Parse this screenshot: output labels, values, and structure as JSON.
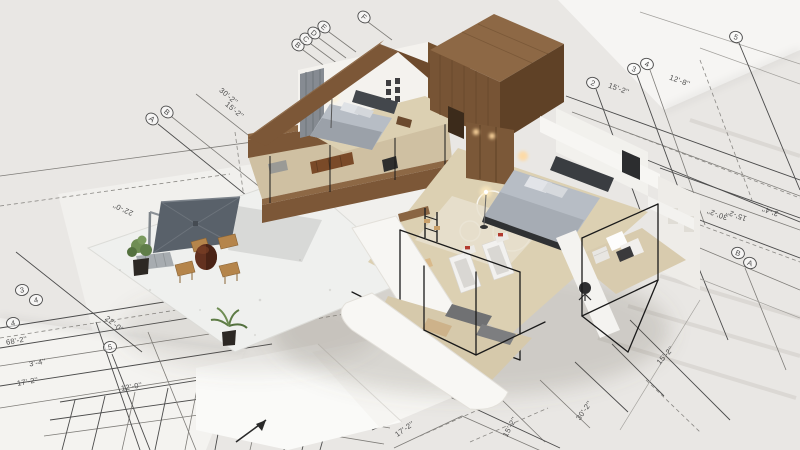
{
  "scene": {
    "subject": "3D cutaway house model standing on architectural blueprints",
    "rooms": [
      "bedroom-1",
      "bedroom-2",
      "gym",
      "closet-office",
      "patio-terrace",
      "lower-floor"
    ]
  },
  "blueprint": {
    "dimension_labels": [
      {
        "text": "30'-2''",
        "x": 227,
        "y": 98,
        "rot": 40
      },
      {
        "text": "15'-2''",
        "x": 233,
        "y": 112,
        "rot": 40
      },
      {
        "text": "15'-2''",
        "x": 618,
        "y": 91,
        "rot": 20
      },
      {
        "text": "12'-8''",
        "x": 679,
        "y": 83,
        "rot": 20
      },
      {
        "text": "30'-2''",
        "x": 718,
        "y": 212,
        "rot": 200
      },
      {
        "text": "15'-2''",
        "x": 737,
        "y": 213,
        "rot": 200
      },
      {
        "text": "3'-4''",
        "x": 771,
        "y": 209,
        "rot": 200
      },
      {
        "text": "15'-2''",
        "x": 667,
        "y": 357,
        "rot": -48
      },
      {
        "text": "30'-2''",
        "x": 586,
        "y": 412,
        "rot": -55
      },
      {
        "text": "15'-2''",
        "x": 512,
        "y": 428,
        "rot": -62
      },
      {
        "text": "17'-2''",
        "x": 406,
        "y": 431,
        "rot": -35
      },
      {
        "text": "17'-2''",
        "x": 208,
        "y": 428,
        "rot": -12
      },
      {
        "text": "22'-0''",
        "x": 113,
        "y": 326,
        "rot": 38
      },
      {
        "text": "22'-0''",
        "x": 124,
        "y": 207,
        "rot": 205
      },
      {
        "text": "68'-2''",
        "x": 17,
        "y": 343,
        "rot": -10
      },
      {
        "text": "3'-4''",
        "x": 38,
        "y": 365,
        "rot": -10
      },
      {
        "text": "17'-2''",
        "x": 28,
        "y": 384,
        "rot": -10
      },
      {
        "text": "12'-0''",
        "x": 132,
        "y": 389,
        "rot": -10
      }
    ],
    "grid_markers": [
      {
        "label": "2",
        "x": 593,
        "y": 83,
        "rot": 20
      },
      {
        "label": "3",
        "x": 634,
        "y": 69,
        "rot": 20
      },
      {
        "label": "4",
        "x": 647,
        "y": 64,
        "rot": 20
      },
      {
        "label": "5",
        "x": 736,
        "y": 37,
        "rot": 20
      },
      {
        "label": "D",
        "x": 668,
        "y": 196,
        "rot": 20
      },
      {
        "label": "C",
        "x": 682,
        "y": 205,
        "rot": 20
      },
      {
        "label": "B",
        "x": 738,
        "y": 253,
        "rot": 20
      },
      {
        "label": "A",
        "x": 750,
        "y": 263,
        "rot": 20
      },
      {
        "label": "7",
        "x": 299,
        "y": 388,
        "rot": 8
      },
      {
        "label": "8",
        "x": 317,
        "y": 392,
        "rot": 8
      },
      {
        "label": "9",
        "x": 335,
        "y": 397,
        "rot": 8
      },
      {
        "label": "3",
        "x": 22,
        "y": 290,
        "rot": -10
      },
      {
        "label": "4",
        "x": 36,
        "y": 300,
        "rot": -10
      },
      {
        "label": "4",
        "x": 13,
        "y": 323,
        "rot": -10
      },
      {
        "label": "5",
        "x": 110,
        "y": 347,
        "rot": -10
      },
      {
        "label": "A",
        "x": 152,
        "y": 119,
        "rot": 40
      },
      {
        "label": "B",
        "x": 167,
        "y": 112,
        "rot": 40
      },
      {
        "label": "B",
        "x": 298,
        "y": 45,
        "rot": 40
      },
      {
        "label": "C",
        "x": 306,
        "y": 39,
        "rot": 40
      },
      {
        "label": "D",
        "x": 314,
        "y": 33,
        "rot": 40
      },
      {
        "label": "E",
        "x": 324,
        "y": 27,
        "rot": 40
      },
      {
        "label": "F",
        "x": 364,
        "y": 17,
        "rot": 40
      }
    ]
  },
  "colors": {
    "paper-base": "#e9e7e4",
    "paper-bright": "#f6f5f3",
    "line-dark": "#4b4b4b",
    "line-light": "#a3a19d",
    "wood-top": "#8d6845",
    "wood-mid": "#7c5737",
    "wood-dark": "#5f4126",
    "slab-white": "#f7f6f3",
    "floor-beige": "#dcd0b2",
    "carpet": "#e7e0cf",
    "bed-gray": "#b7bdc5",
    "bed-dark": "#3a3d41",
    "umbrella-gray": "#59616a",
    "chair-tan": "#b5854b",
    "plant-green": "#5f7d49",
    "glow-warm": "#ffd9a0",
    "frame-black": "#1a1a1a",
    "accent-red": "#b23a2e"
  }
}
